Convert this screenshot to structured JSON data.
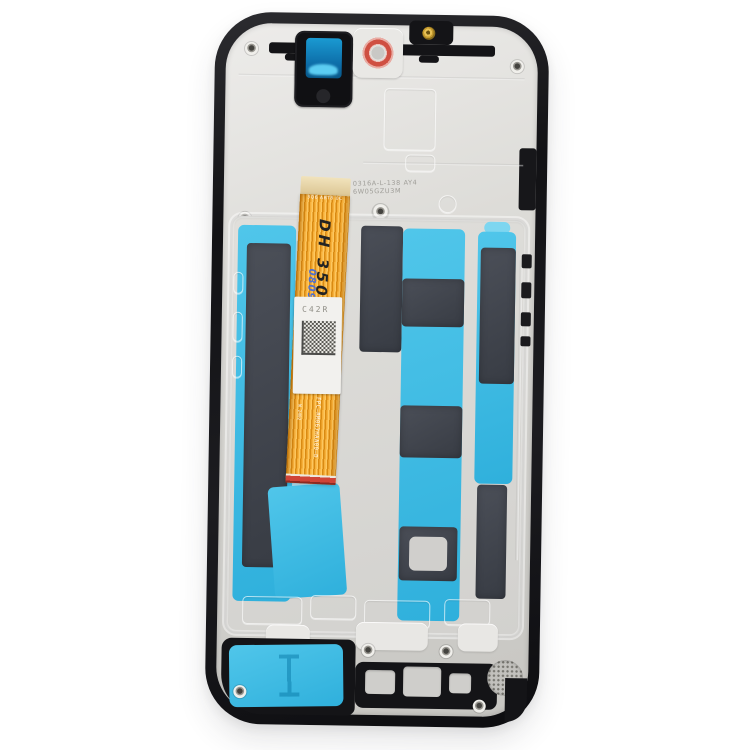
{
  "scene": {
    "description": "Rear view photo of a smartphone LCD screen assembly replacement part with frame, on a white background",
    "background_color": "#ffffff"
  },
  "colors": {
    "frame_black": "#17171a",
    "plate_silver": "#d8d7d4",
    "adhesive_cyan": "#3fbce6",
    "graphite_dark": "#42464f",
    "flex_orange": "#f2a62c",
    "grommet_red": "#cf4f42",
    "screw_gold": "#c9a22e",
    "marker_blue_ink": "#4f6fd0"
  },
  "labels": {
    "sticker_code": "C42R",
    "flex_code": "FPC—RM067HAA00—D",
    "flex_batch": "W 2402",
    "marker_black": "DH 35080",
    "marker_blue": "080930",
    "etched_line1": "0316A-L-138 AY4",
    "etched_line2": "6W05GZU3M",
    "flex_top_code": "3Q6 ABT8 0C"
  }
}
